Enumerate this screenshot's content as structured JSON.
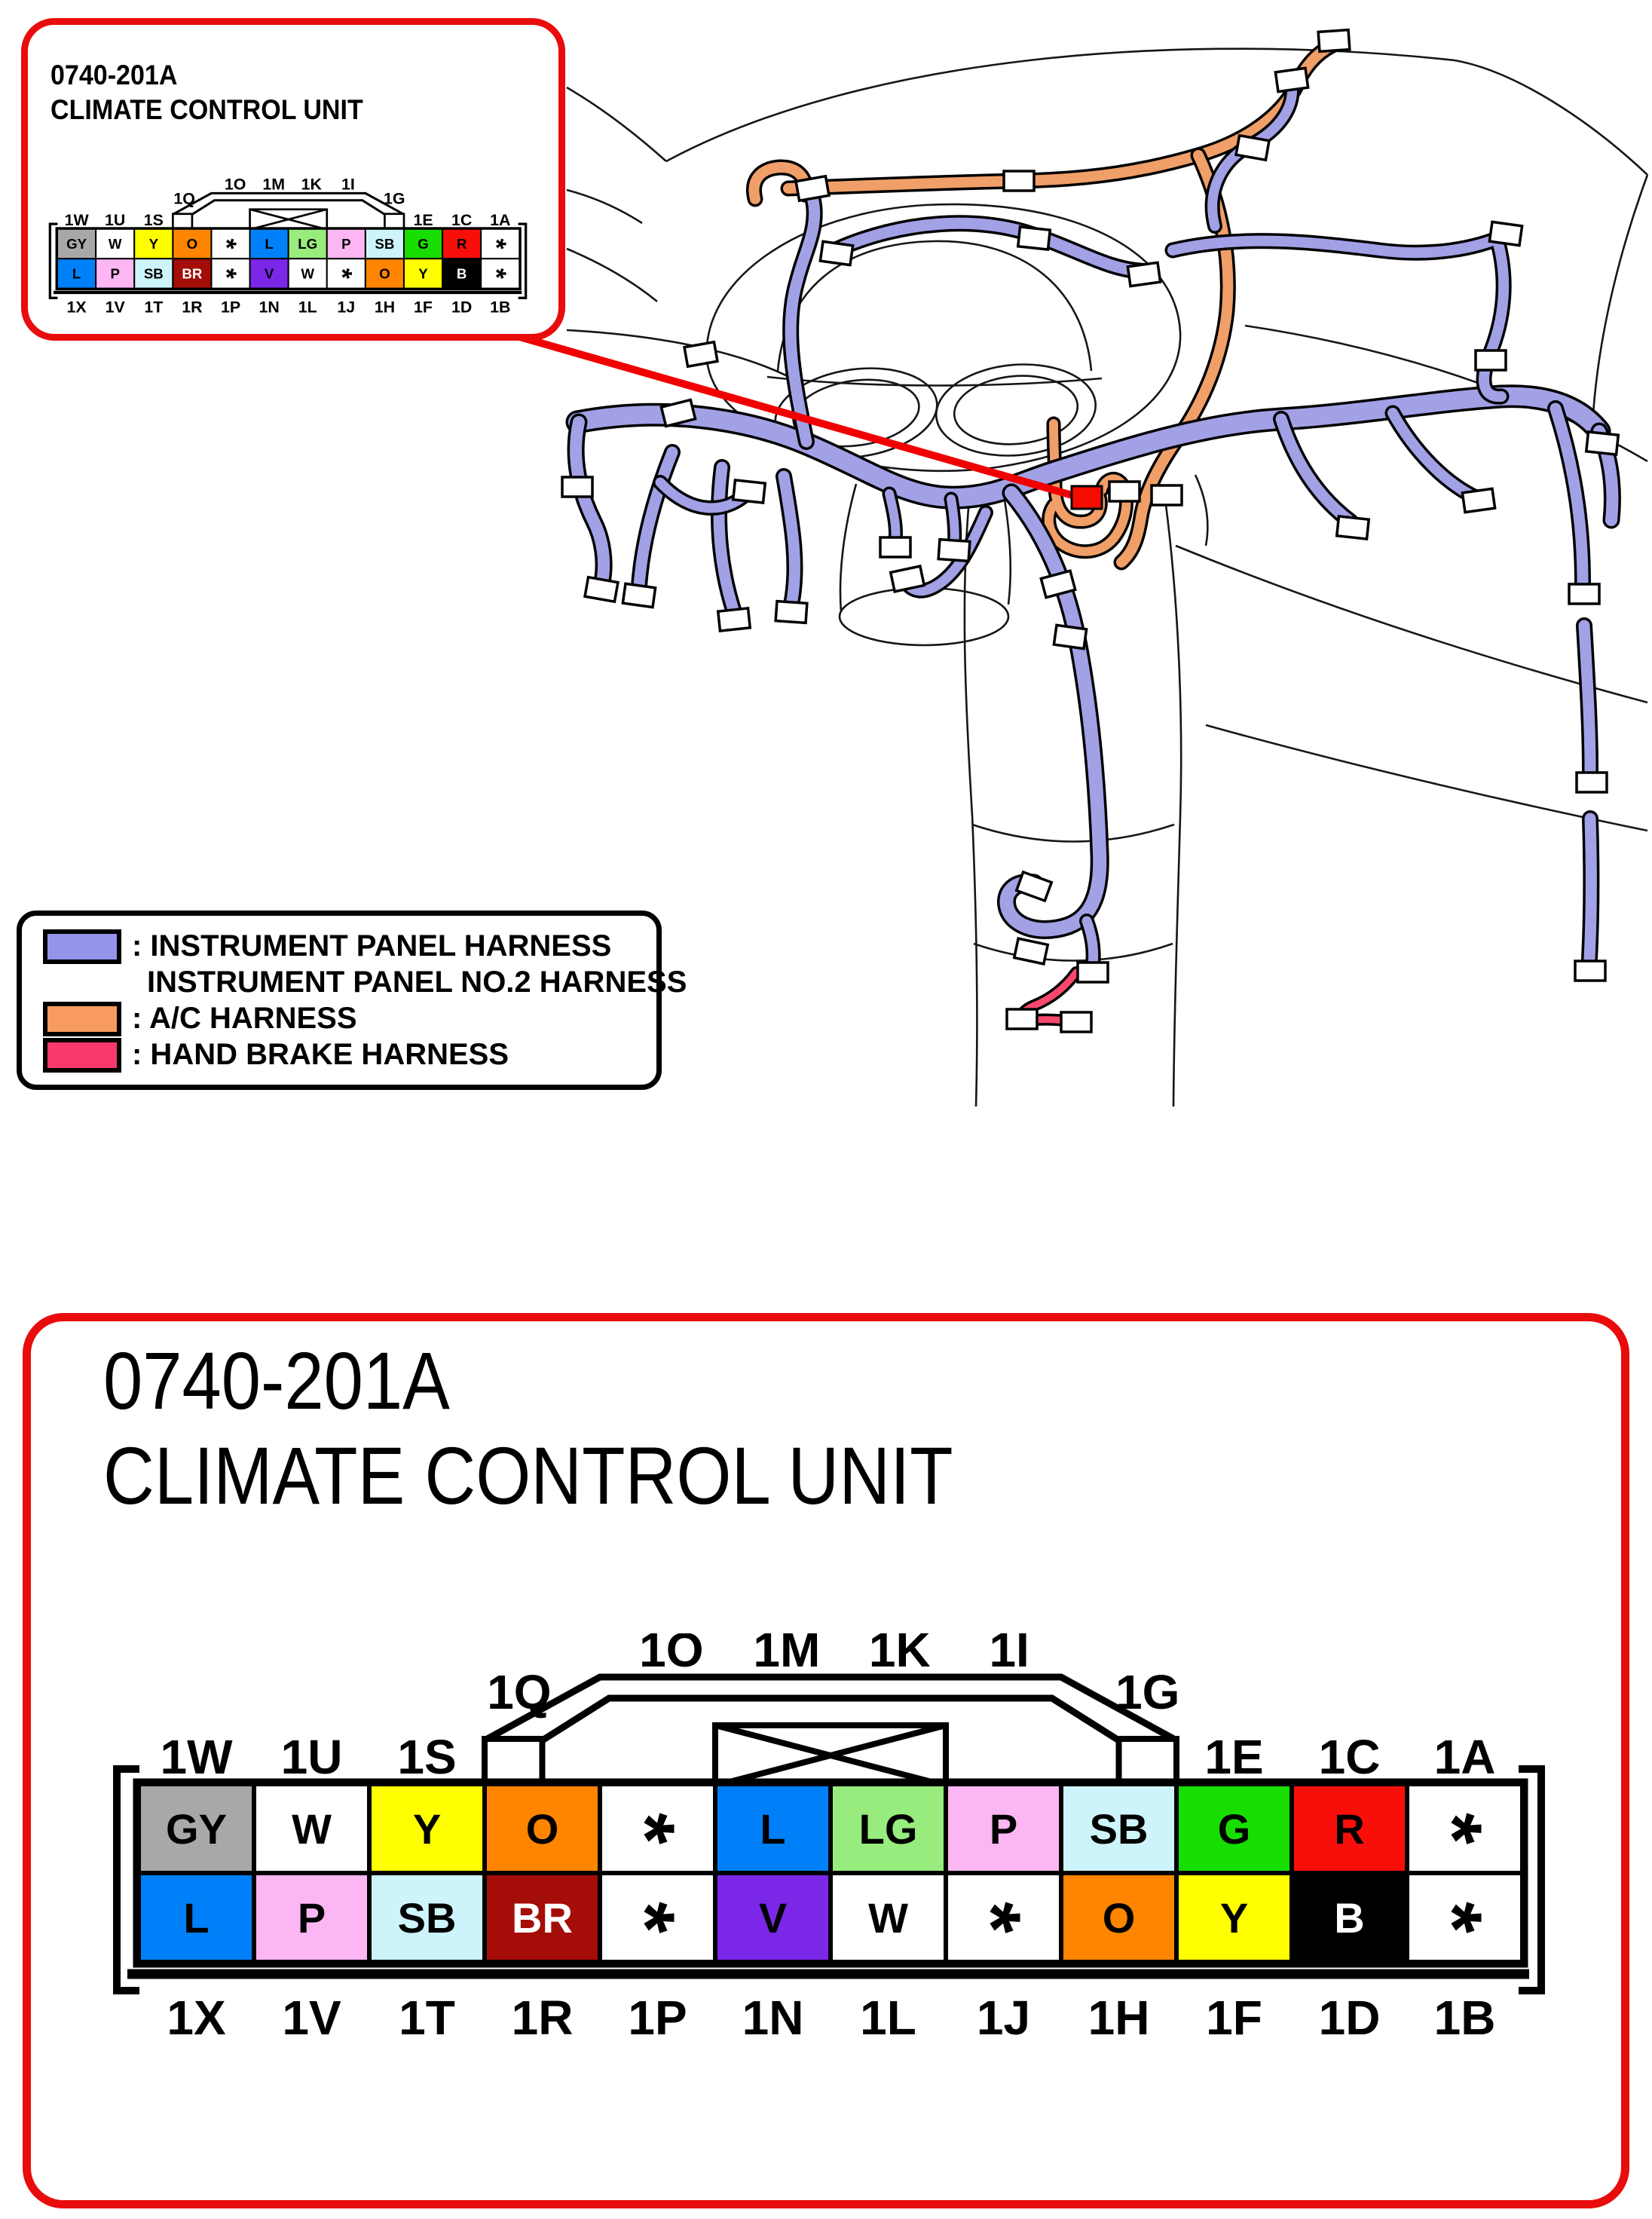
{
  "inset_callout": {
    "code": "0740-201A",
    "name": "CLIMATE CONTROL UNIT"
  },
  "detail_callout": {
    "code": "0740-201A",
    "name": "CLIMATE CONTROL UNIT"
  },
  "legend": {
    "items": [
      {
        "icon": "instrument-panel-harness-swatch",
        "color": "#9693ea",
        "lines": [
          ": INSTRUMENT PANEL HARNESS",
          "INSTRUMENT PANEL NO.2 HARNESS"
        ]
      },
      {
        "icon": "ac-harness-swatch",
        "color": "#f89b60",
        "lines": [
          ": A/C HARNESS"
        ]
      },
      {
        "icon": "hand-brake-harness-swatch",
        "color": "#f9396b",
        "lines": [
          ": HAND BRAKE HARNESS"
        ]
      }
    ]
  },
  "connector": {
    "top_labels_left": [
      "1W",
      "1U",
      "1S"
    ],
    "roof_corner_labels": [
      "1Q",
      "1G"
    ],
    "roof_labels": [
      "1O",
      "1M",
      "1K",
      "1I"
    ],
    "top_labels_right": [
      "1E",
      "1C",
      "1A"
    ],
    "bottom_labels": [
      "1X",
      "1V",
      "1T",
      "1R",
      "1P",
      "1N",
      "1L",
      "1J",
      "1H",
      "1F",
      "1D",
      "1B"
    ],
    "rows": [
      {
        "name": "top",
        "pins": [
          {
            "label": "GY",
            "color": "#a8a8a8",
            "text_color": "#000000"
          },
          {
            "label": "W",
            "color": "#ffffff",
            "text_color": "#000000"
          },
          {
            "label": "Y",
            "color": "#ffff00",
            "text_color": "#000000"
          },
          {
            "label": "O",
            "color": "#ff8500",
            "text_color": "#000000"
          },
          {
            "label": "*",
            "color": "#ffffff",
            "text_color": "#000000"
          },
          {
            "label": "L",
            "color": "#0080f8",
            "text_color": "#000000"
          },
          {
            "label": "LG",
            "color": "#97ec7d",
            "text_color": "#000000"
          },
          {
            "label": "P",
            "color": "#fdb6f4",
            "text_color": "#000000"
          },
          {
            "label": "SB",
            "color": "#cdf4fa",
            "text_color": "#000000"
          },
          {
            "label": "G",
            "color": "#17dd00",
            "text_color": "#000000"
          },
          {
            "label": "R",
            "color": "#f90f0a",
            "text_color": "#000000"
          },
          {
            "label": "*",
            "color": "#ffffff",
            "text_color": "#000000"
          }
        ]
      },
      {
        "name": "bottom",
        "pins": [
          {
            "label": "L",
            "color": "#0080f8",
            "text_color": "#000000"
          },
          {
            "label": "P",
            "color": "#fdb6f4",
            "text_color": "#000000"
          },
          {
            "label": "SB",
            "color": "#cdf4fa",
            "text_color": "#000000"
          },
          {
            "label": "BR",
            "color": "#a40d08",
            "text_color": "#ffffff"
          },
          {
            "label": "*",
            "color": "#ffffff",
            "text_color": "#000000"
          },
          {
            "label": "V",
            "color": "#7b27e8",
            "text_color": "#000000"
          },
          {
            "label": "W",
            "color": "#ffffff",
            "text_color": "#000000"
          },
          {
            "label": "*",
            "color": "#ffffff",
            "text_color": "#000000"
          },
          {
            "label": "O",
            "color": "#ff8500",
            "text_color": "#000000"
          },
          {
            "label": "Y",
            "color": "#ffff00",
            "text_color": "#000000"
          },
          {
            "label": "B",
            "color": "#000000",
            "text_color": "#ffffff"
          },
          {
            "label": "*",
            "color": "#ffffff",
            "text_color": "#000000"
          }
        ]
      }
    ]
  },
  "colors": {
    "callout_border": "#e80c0c",
    "instrument_panel_harness": "#a2a1e6",
    "ac_harness": "#f09f68",
    "hand_brake_harness": "#f9486e",
    "leader_line": "#f00000",
    "highlight_connector": "#f70d00"
  }
}
